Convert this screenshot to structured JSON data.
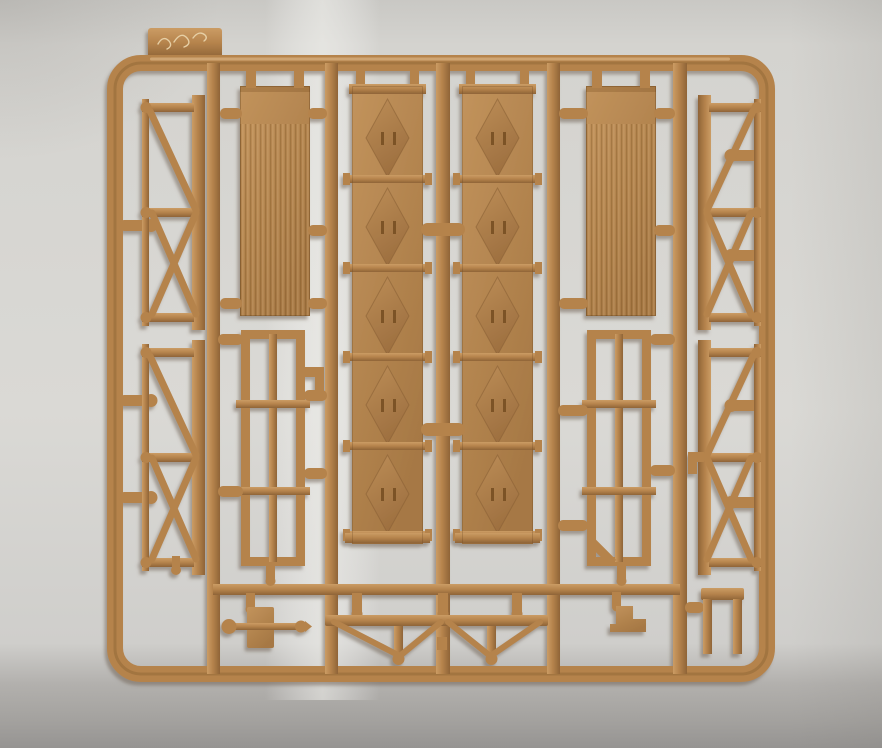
{
  "meta": {
    "type": "photograph",
    "subject": "Tan plastic injection-molded model-kit sprue (runner with parts) photographed on a light grey paper backdrop"
  },
  "palette": {
    "plastic-mid": "#b5834c",
    "plastic-hi": "#cb9c64",
    "plastic-lo": "#8f6437",
    "plastic-edge": "#6f4a26",
    "panel-hi": "#c2935c",
    "panel-lo": "#a67844",
    "diamond-hi": "#bc8d57",
    "diamond-lo": "#9e7040",
    "bg-light": "#dad9d5",
    "bg-mid": "#cfcecb",
    "bg-dark": "#a3a19e",
    "bg-darker": "#969492",
    "shadow": "#6b5c50"
  },
  "sprue": {
    "frame": "outer sprue frame — rounded-rectangle runner",
    "tab": "mold tab with scratched marking",
    "engraving": "(illegible handwritten scribble)",
    "runner_vertical": "vertical feed runner",
    "runner_horizontal": "horizontal feed runner",
    "gate": "round-tipped sprue gate",
    "parts": {
      "truss_left_top": "X-braced end truss (upper left)",
      "truss_left_bottom": "X-braced end truss (lower left)",
      "truss_right_top": "X-braced end truss (upper right)",
      "truss_right_bottom": "X-braced end truss (lower right)",
      "planked_panel_left": "planked wall panel (left)",
      "planked_panel_right": "planked wall panel (right)",
      "braced_door_left": "segmented panel with pressed diamond stiffeners (left of center)",
      "braced_door_right": "segmented panel with pressed diamond stiffeners (right of center)",
      "lattice_frame_left": "open lattice frame with centre mullion (left)",
      "lattice_frame_right": "open lattice frame with centre mullion, chamfered corner (right)",
      "axle_plate": "small plate with cross rod and end knobs",
      "braced_beam": "long beam with V-bracing and twin posts",
      "step_bracket": "small stepped bracket",
      "bench": "small bench-shaped part",
      "elbow_fitting": "small L-shaped fitting"
    }
  }
}
